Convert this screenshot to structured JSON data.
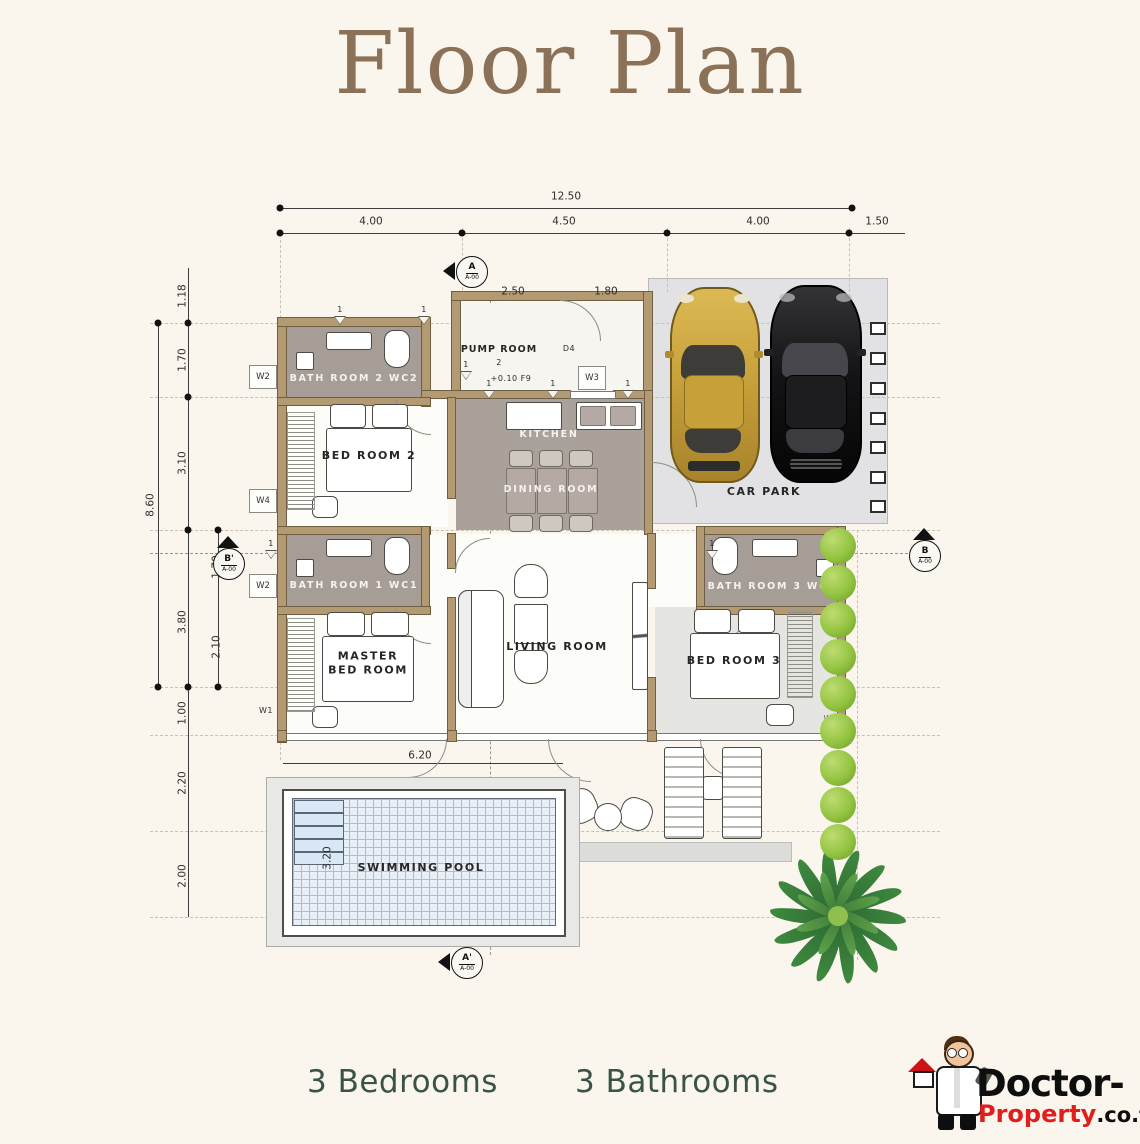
{
  "title": "Floor Plan",
  "summary": {
    "bedrooms": "3 Bedrooms",
    "bathrooms": "3 Bathrooms"
  },
  "logo": {
    "brand": "Doctor-",
    "brand_red": "Property",
    "brand_tld": ".co.th"
  },
  "colors": {
    "background": "#faf6ee",
    "title": "#8a7157",
    "summary_text": "#3a5347",
    "wall": "#b39a72",
    "bathroom_fill": "#a79d97",
    "carpark_fill": "#e2e2e4",
    "pool_water": "#e9eff6",
    "bush_green": "#93c440",
    "palm_green": "#2d6a33",
    "car_gold": "#c9a23c",
    "car_black": "#151517",
    "logo_red": "#e21d1d"
  },
  "plan": {
    "rooms": [
      "BATH ROOM 2 WC2",
      "BED ROOM 2",
      "PUMP ROOM",
      "KITCHEN",
      "DINING ROOM",
      "CAR PARK",
      "BATH ROOM 1 WC1",
      "MASTER BED ROOM",
      "LIVING ROOM",
      "BATH ROOM 3 WC3",
      "BED ROOM 3",
      "SWIMMING POOL"
    ],
    "dimensions": {
      "top_total": "12.50",
      "top_segments": [
        "4.00",
        "4.50",
        "4.00",
        "1.50"
      ],
      "top_inner": [
        "2.50",
        "1.80"
      ],
      "left_total": "8.60",
      "left_segments": [
        "1.18",
        "1.70",
        "3.10",
        "1.70",
        "3.80",
        "2.10",
        "1.00",
        "2.20",
        "2.00"
      ],
      "pool": [
        "6.20",
        "3.20"
      ],
      "pump_room_level": "+0.10  F9"
    },
    "labels": [
      {
        "t": "12.50",
        "x": 566,
        "y": 197,
        "c": "dim"
      },
      {
        "t": "4.00",
        "x": 371,
        "y": 222,
        "c": "dim"
      },
      {
        "t": "4.50",
        "x": 564,
        "y": 222,
        "c": "dim"
      },
      {
        "t": "4.00",
        "x": 758,
        "y": 222,
        "c": "dim"
      },
      {
        "t": "1.50",
        "x": 877,
        "y": 222,
        "c": "dim"
      },
      {
        "t": "2.50",
        "x": 513,
        "y": 292,
        "c": "dim"
      },
      {
        "t": "1.80",
        "x": 606,
        "y": 292,
        "c": "dim"
      },
      {
        "t": "1.18",
        "x": 183,
        "y": 296,
        "c": "dimv"
      },
      {
        "t": "1.70",
        "x": 183,
        "y": 360,
        "c": "dimv"
      },
      {
        "t": "3.10",
        "x": 183,
        "y": 463,
        "c": "dimv"
      },
      {
        "t": "8.60",
        "x": 151,
        "y": 505,
        "c": "dimv"
      },
      {
        "t": "1.70",
        "x": 217,
        "y": 567,
        "c": "dimv"
      },
      {
        "t": "3.80",
        "x": 183,
        "y": 622,
        "c": "dimv"
      },
      {
        "t": "2.10",
        "x": 217,
        "y": 647,
        "c": "dimv"
      },
      {
        "t": "1.00",
        "x": 183,
        "y": 713,
        "c": "dimv"
      },
      {
        "t": "2.20",
        "x": 183,
        "y": 783,
        "c": "dimv"
      },
      {
        "t": "2.00",
        "x": 183,
        "y": 876,
        "c": "dimv"
      },
      {
        "t": "3.20",
        "x": 328,
        "y": 858,
        "c": "dimv"
      },
      {
        "t": "6.20",
        "x": 420,
        "y": 756,
        "c": "dim"
      },
      {
        "t": "BATH ROOM 2 WC2",
        "x": 354,
        "y": 379,
        "c": "roomw"
      },
      {
        "t": "BED ROOM 2",
        "x": 369,
        "y": 456,
        "c": "room"
      },
      {
        "t": "PUMP ROOM",
        "x": 499,
        "y": 350,
        "c": "roomsm"
      },
      {
        "t": "2",
        "x": 499,
        "y": 363,
        "c": "tiny"
      },
      {
        "t": "+0.10  F9",
        "x": 511,
        "y": 379,
        "c": "tiny"
      },
      {
        "t": "KITCHEN",
        "x": 549,
        "y": 435,
        "c": "roomw"
      },
      {
        "t": "DINING ROOM",
        "x": 551,
        "y": 490,
        "c": "roomw"
      },
      {
        "t": "CAR PARK",
        "x": 764,
        "y": 492,
        "c": "room"
      },
      {
        "t": "BATH ROOM 1 WC1",
        "x": 354,
        "y": 586,
        "c": "roomw"
      },
      {
        "t": "MASTER\nBED ROOM",
        "x": 368,
        "y": 663,
        "c": "room"
      },
      {
        "t": "LIVING ROOM",
        "x": 557,
        "y": 647,
        "c": "room"
      },
      {
        "t": "BATH ROOM 3 WC3",
        "x": 772,
        "y": 587,
        "c": "roomw"
      },
      {
        "t": "BED ROOM 3",
        "x": 734,
        "y": 661,
        "c": "room"
      },
      {
        "t": "SWIMMING POOL",
        "x": 421,
        "y": 868,
        "c": "room"
      },
      {
        "t": "D4",
        "x": 569,
        "y": 349,
        "c": "tiny"
      },
      {
        "t": "W1",
        "x": 266,
        "y": 711,
        "c": "tiny"
      },
      {
        "t": "W2",
        "x": 830,
        "y": 589,
        "c": "tinyf"
      },
      {
        "t": "W2",
        "x": 830,
        "y": 719,
        "c": "tinyf"
      }
    ],
    "window_tags": [
      {
        "t": "W2",
        "x": 263,
        "y": 377
      },
      {
        "t": "W4",
        "x": 263,
        "y": 501
      },
      {
        "t": "W2",
        "x": 263,
        "y": 586
      },
      {
        "t": "W3",
        "x": 592,
        "y": 378
      }
    ],
    "grid_flags": [
      {
        "n": "1",
        "x": 340,
        "y": 316
      },
      {
        "n": "1",
        "x": 424,
        "y": 316
      },
      {
        "n": "1",
        "x": 466,
        "y": 371
      },
      {
        "n": "1",
        "x": 489,
        "y": 390
      },
      {
        "n": "1",
        "x": 553,
        "y": 390
      },
      {
        "n": "1",
        "x": 628,
        "y": 390
      },
      {
        "n": "1",
        "x": 271,
        "y": 550
      },
      {
        "n": "1",
        "x": 712,
        "y": 550
      }
    ],
    "section_markers": [
      {
        "l": "A",
        "s": "A-00",
        "x": 472,
        "y": 272,
        "d": "left"
      },
      {
        "l": "A'",
        "s": "A-00",
        "x": 467,
        "y": 963,
        "d": "left"
      },
      {
        "l": "B'",
        "s": "A-00",
        "x": 229,
        "y": 564,
        "d": "up"
      },
      {
        "l": "B",
        "s": "A-00",
        "x": 925,
        "y": 556,
        "d": "up"
      }
    ]
  }
}
